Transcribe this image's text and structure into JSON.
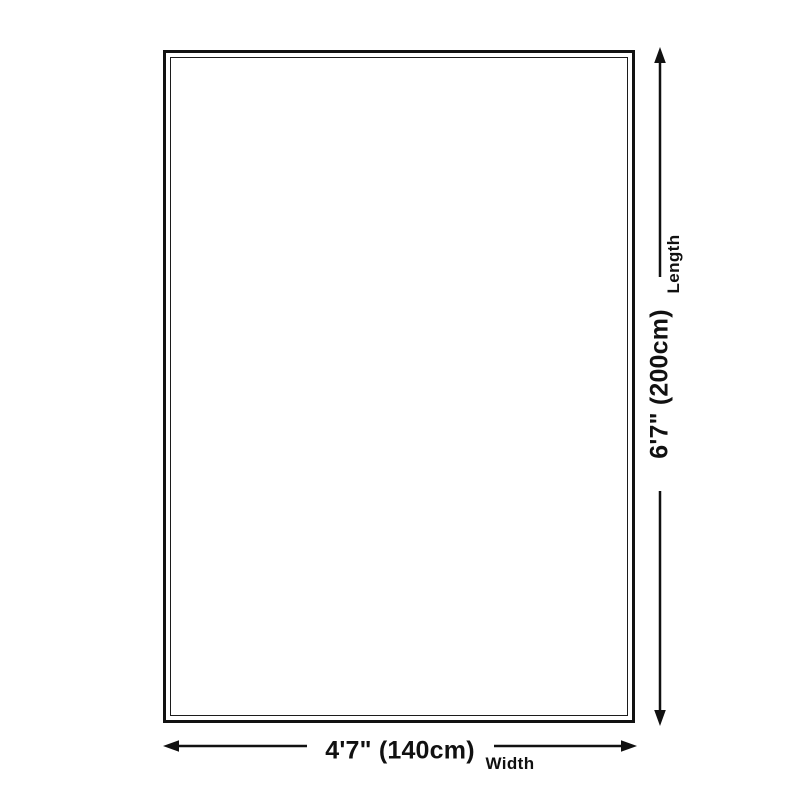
{
  "diagram": {
    "shape": "rectangle-double-border",
    "length": {
      "value": "6'7\" (200cm)",
      "label": "Length"
    },
    "width": {
      "value": "4'7\" (140cm)",
      "label": "Width"
    },
    "colors": {
      "line": "#111111",
      "border_outer": "#121212",
      "border_inner": "#1c1c1c",
      "background": "#ffffff"
    }
  }
}
